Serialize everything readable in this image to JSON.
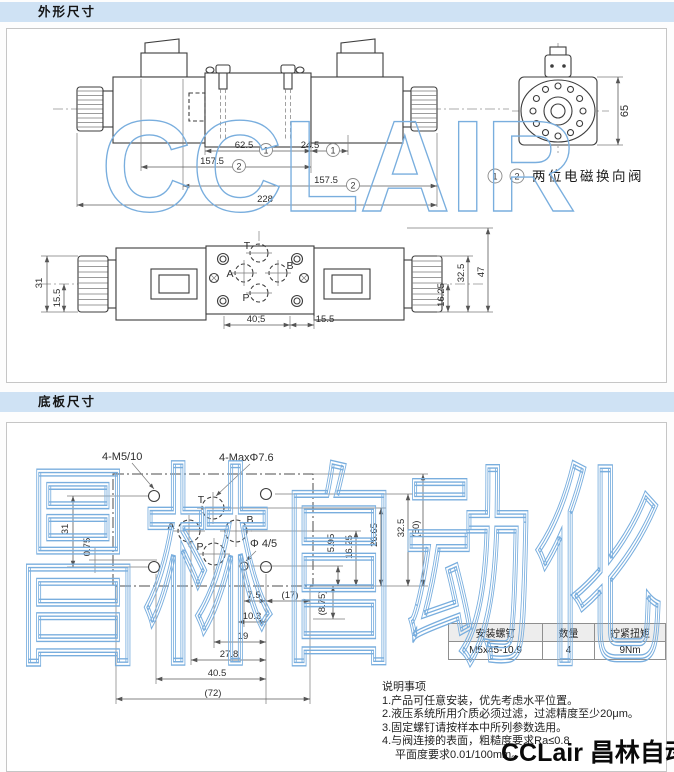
{
  "headers": {
    "outline": "外形尺寸",
    "plate": "底板尺寸"
  },
  "colors": {
    "header_bg": "#cfe2f4",
    "watermark_blue": "#79aede",
    "line": "#3d3d3d"
  },
  "watermarks": {
    "outline_text": "CCLAIR",
    "plate_text": "昌林自动化",
    "brand_footer": "CCLair 昌林自动化"
  },
  "outline_section": {
    "legend": {
      "tag1": "1",
      "tag2": "2",
      "label": "两位电磁换向阀"
    },
    "side_view": {
      "dim_62_5": "62.5",
      "tag_a": "1",
      "dim_24_5": "24.5",
      "tag_b": "1",
      "dim_157_5_top": "157.5",
      "tag_c": "2",
      "dim_157_5_bottom": "157.5",
      "tag_d": "2",
      "dim_228": "228"
    },
    "end_view": {
      "dim_65": "65"
    },
    "top_view": {
      "port_t": "T",
      "port_a": "A",
      "port_b": "B",
      "port_p": "P",
      "dim_31": "31",
      "dim_15_5_left": "15.5",
      "dim_40_5": "40.5",
      "dim_15_5_bottom": "15.5",
      "dim_16_25": "16.25",
      "dim_32_5": "32.5",
      "dim_47": "47"
    }
  },
  "plate_section": {
    "hole_labels": {
      "m5": "4-M5/10",
      "max_phi": "4-MaxΦ7.6",
      "phi45": "Φ 4/5"
    },
    "ports": {
      "t": "T",
      "a": "A",
      "b": "B",
      "p": "P"
    },
    "dims": {
      "left_31": "31",
      "left_0_75": "0.75",
      "right_5_95": "5.95",
      "right_16_25": "16.25",
      "right_26_65": "26.65",
      "right_32_5": "32.5",
      "right_50": "(50)",
      "mid_8_75": "(8.75)",
      "b_7_5": "7.5",
      "b_17": "(17)",
      "b_10_3": "10.3",
      "b_19": "19",
      "b_27_8": "27.8",
      "b_40_5": "40.5",
      "b_72": "(72)"
    },
    "table": {
      "headers": [
        "安装螺钉",
        "数量",
        "拧紧扭矩"
      ],
      "row": [
        "M5x45-10.9",
        "4",
        "9Nm"
      ]
    },
    "notes": {
      "title": "说明事项",
      "items": [
        "1.产品可任意安装，优先考虑水平位置。",
        "2.液压系统所用介质必须过滤，过滤精度至少20μm。",
        "3.固定螺钉请按样本中所列参数选用。",
        "4.与阀连接的表面，粗糙度要求Ra≤0.8",
        "平面度要求0.01/100mm。"
      ]
    }
  }
}
